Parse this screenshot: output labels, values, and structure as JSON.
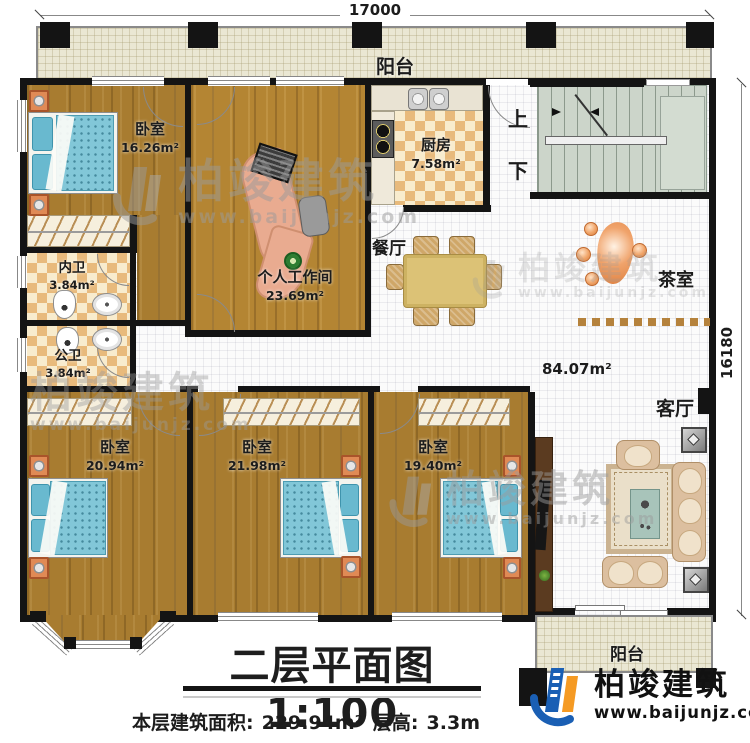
{
  "plan": {
    "title": "二层平面图1:100",
    "footer": {
      "area_label": "本层建筑面积:",
      "area_value": "229.94m²",
      "height_label": "层高:",
      "height_value": "3.3m"
    },
    "dimensions": {
      "width": "17000",
      "height": "16180"
    },
    "rooms": {
      "balcony_top": {
        "label": "阳台"
      },
      "bedroom_tl": {
        "label": "卧室",
        "area": "16.26m²"
      },
      "workroom": {
        "label": "个人工作间",
        "area": "23.69m²"
      },
      "kitchen": {
        "label": "厨房",
        "area": "7.58m²"
      },
      "inner_bath": {
        "label": "内卫",
        "area": "3.84m²"
      },
      "public_bath": {
        "label": "公卫",
        "area": "3.84m²"
      },
      "dining": {
        "label": "餐厅"
      },
      "tea_room": {
        "label": "茶室"
      },
      "hall": {
        "area": "84.07m²"
      },
      "living": {
        "label": "客厅"
      },
      "bedroom_bl": {
        "label": "卧室",
        "area": "20.94m²"
      },
      "bedroom_bm": {
        "label": "卧室",
        "area": "21.98m²"
      },
      "bedroom_br": {
        "label": "卧室",
        "area": "19.40m²"
      },
      "balcony_bottom": {
        "label": "阳台"
      }
    },
    "stairs": {
      "up": "上",
      "down": "下"
    },
    "watermark": {
      "brand": "柏竣建筑",
      "url": "www.baijunjz.com"
    },
    "logo": {
      "brand": "柏竣建筑",
      "url": "www.baijunjz.com"
    },
    "colors": {
      "wall": "#141414",
      "logo_blue": "#1a5fb4",
      "logo_orange": "#f59a23"
    }
  }
}
